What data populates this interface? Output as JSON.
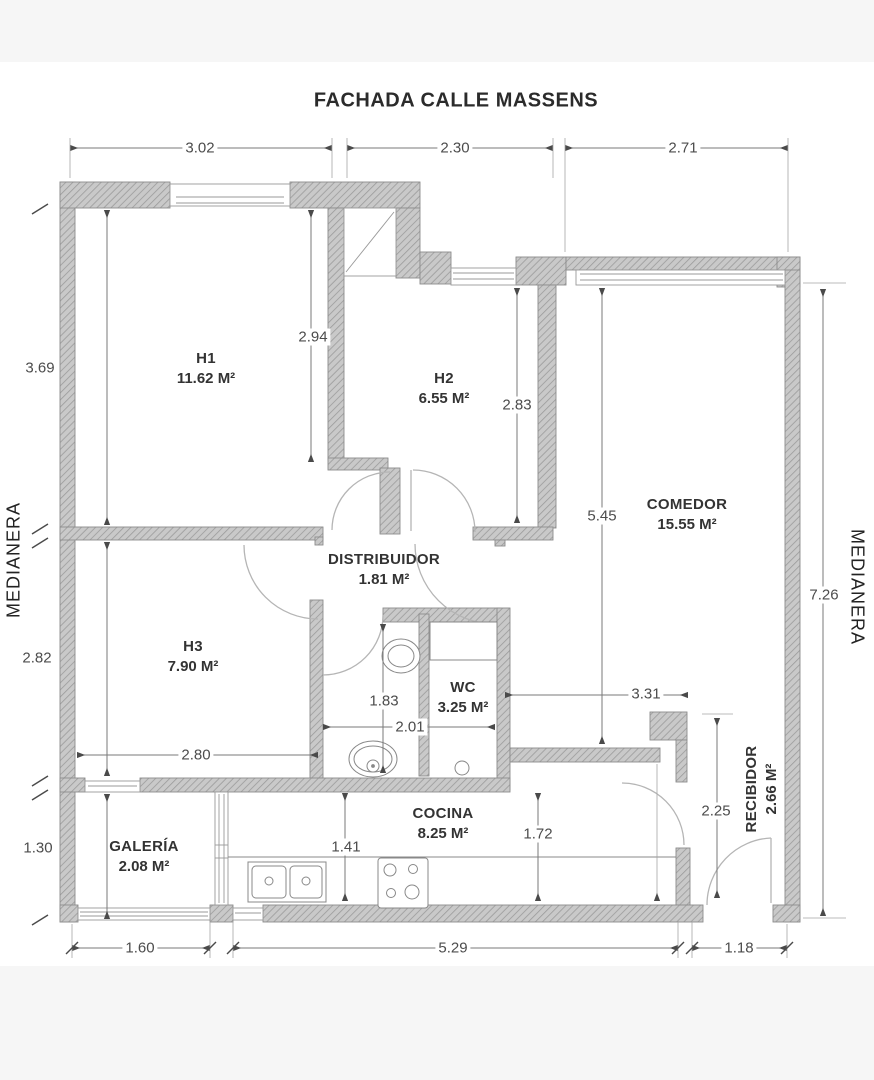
{
  "title": "FACHADA CALLE MASSENS",
  "party_wall_label_left": "MEDIANERA",
  "party_wall_label_right": "MEDIANERA",
  "rooms": [
    {
      "name": "H1",
      "area": "11.62 M²"
    },
    {
      "name": "H2",
      "area": "6.55 M²"
    },
    {
      "name": "H3",
      "area": "7.90 M²"
    },
    {
      "name": "COMEDOR",
      "area": "15.55 M²"
    },
    {
      "name": "DISTRIBUIDOR",
      "area": "1.81 M²"
    },
    {
      "name": "WC",
      "area": "3.25 M²"
    },
    {
      "name": "COCINA",
      "area": "8.25 M²"
    },
    {
      "name": "GALERÍA",
      "area": "2.08 M²"
    },
    {
      "name": "RECIBIDOR",
      "area": "2.66 M²"
    }
  ],
  "dimensions": {
    "top": [
      "3.02",
      "2.30",
      "2.71"
    ],
    "left": [
      "3.69",
      "2.82",
      "1.30"
    ],
    "right": [
      "7.26"
    ],
    "bottom": [
      "1.60",
      "5.29",
      "1.18"
    ],
    "interior": [
      "2.94",
      "2.83",
      "5.45",
      "3.31",
      "2.25",
      "1.83",
      "2.01",
      "2.80",
      "1.41",
      "1.72"
    ]
  }
}
